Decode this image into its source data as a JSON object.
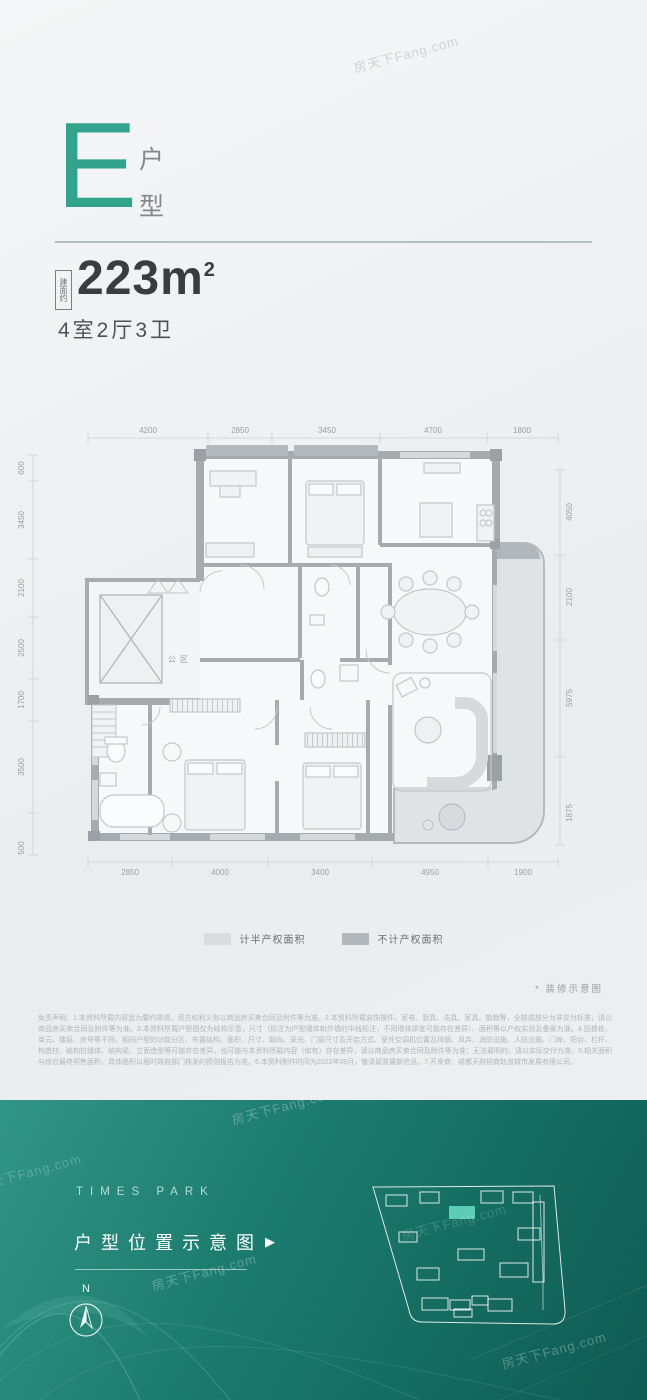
{
  "watermark": {
    "text": "房天下Fang.com"
  },
  "header": {
    "unit_letter": "E",
    "unit_type_char1": "户",
    "unit_type_char2": "型",
    "area_prefix": "建面约",
    "area_number": "223m",
    "area_sup": "2",
    "rooms_label": "4室2厅3卫"
  },
  "floorplan": {
    "dims_top": [
      "4200",
      "2850",
      "3450",
      "4700",
      "1800"
    ],
    "dims_bottom": [
      "2850",
      "4000",
      "3400",
      "4950",
      "1900"
    ],
    "dims_left": [
      "600",
      "3450",
      "2100",
      "2500",
      "1700",
      "3500",
      "500"
    ],
    "dims_right": [
      "4050",
      "2100",
      "5975",
      "1875"
    ],
    "public_area_label": "公区",
    "legend": [
      {
        "label": "计半产权面积",
        "color": "#d9dcdf"
      },
      {
        "label": "不计产权面积",
        "color": "#b3b8bc"
      }
    ],
    "note": "* 装修示意图"
  },
  "disclaimer": "免责声明：1.本资料所载内容旨为要约邀请，双方权利义务以商品房买卖合同及附件等为准。2.本资料所载装饰摆件、家电、厨具、洁具、家具、植栽等，全部或部分为非交付标准，请以商品房买卖合同及附件等为准。3.本资料所载户型图仅为结构示意，尺寸（标注为户型墙体和外墙的中线标注，不同墙体厚度可能存在差异）、面积等以产权实测及备案为准。4.因楼栋、单元、楼层、房号等不同，相同户型的功能分区、布置结构、面积、尺寸、朝向、采光、门窗尺寸及开启方式、室外空调机位置及排烟、风井、消防设施、人防设施、门垛、阳台、栏杆、构造柱、结构拉缝体、结构梁、立面造型等可能存在差异，也可能与本资料所载内容（如有）存在差异，请以商品房买卖合同及附件等为准；无法载明的，请以实际交付为准。5.相关面积与综合最终预售面积，具体面积以届时政府部门核发的预测报告为准。6.本资料制作时间为2022年08月，敬请留意最新信息。7.开发商：成都天府招商轨道城市发展有限公司。",
  "footer": {
    "brand": "TIMES PARK",
    "cta": "户型位置示意图",
    "cta_arrow": "▶",
    "compass_n": "N",
    "colors": {
      "bg_start": "#319586",
      "bg_end": "#0e5b52",
      "highlight": "#5bcdb5"
    }
  }
}
